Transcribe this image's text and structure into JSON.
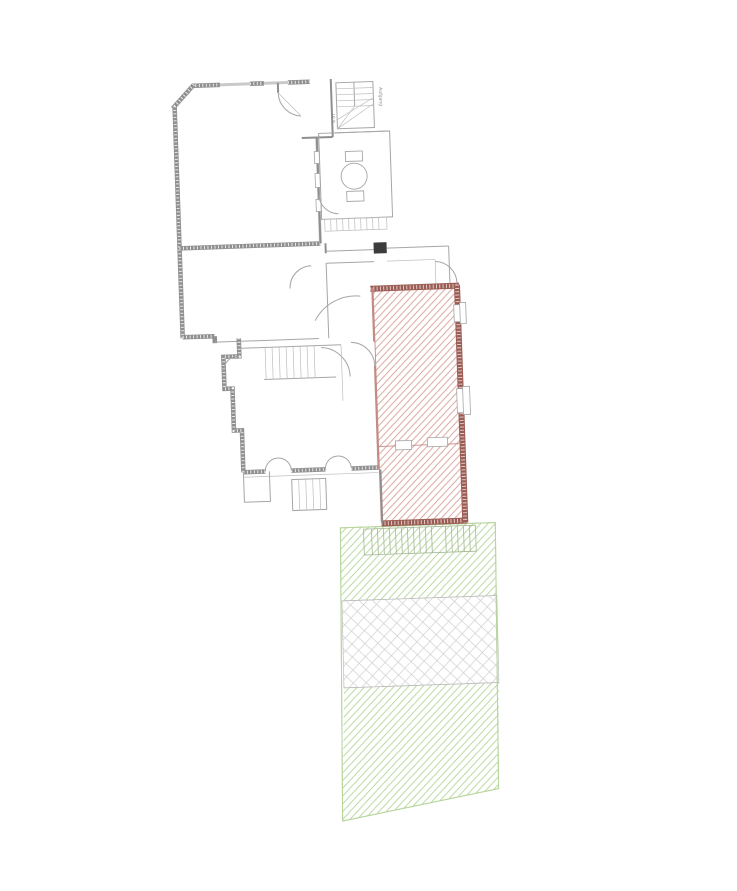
{
  "page": {
    "background": "#ffffff",
    "kind": "architectural floor plan drawing"
  },
  "plan": {
    "annotations": {
      "stair_label": "Aufgang",
      "dimension_label": "4 m"
    },
    "colors": {
      "bg": "#ffffff",
      "wall": "#8f8f8f",
      "wall_light": "#c9c9c9",
      "line": "#a6a6a6",
      "thin": "#bdbdbd",
      "dark": "#3c3c3c",
      "red_wall": "#9a5c53",
      "red_hatch": "#d89d96",
      "red_line": "#c28b84",
      "green_hatch": "#aed391",
      "green_line": "#b7d59c",
      "cross_hatch": "#cfcfcf",
      "tile_line": "#bdbdbd",
      "step_line": "#a4b796"
    }
  }
}
